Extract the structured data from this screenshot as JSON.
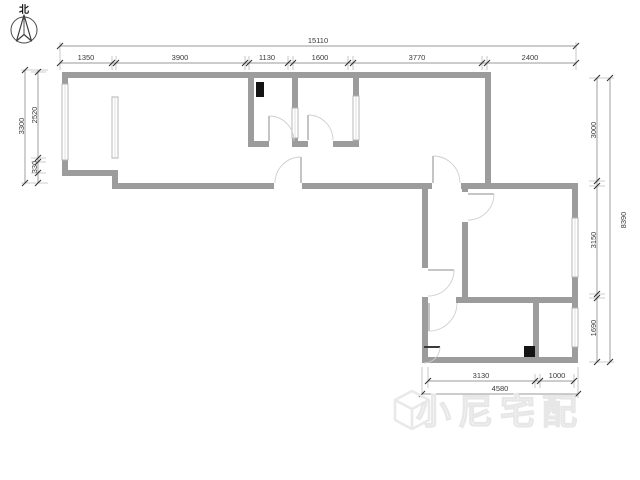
{
  "compass": {
    "label": "北"
  },
  "dimensions": {
    "top": {
      "total": "15110",
      "segments": [
        "1350",
        "3900",
        "1130",
        "1600",
        "3770",
        "2400"
      ]
    },
    "left": {
      "total": "3300",
      "segments": [
        "2520",
        "330"
      ]
    },
    "right": {
      "total": "8390",
      "segments": [
        "3000",
        "3150",
        "1690"
      ]
    },
    "bottom": {
      "total": "4580",
      "segments": [
        "3130",
        "1000"
      ]
    }
  },
  "watermark": {
    "icon": "cube-logo-icon",
    "text": "小尼宅配"
  }
}
